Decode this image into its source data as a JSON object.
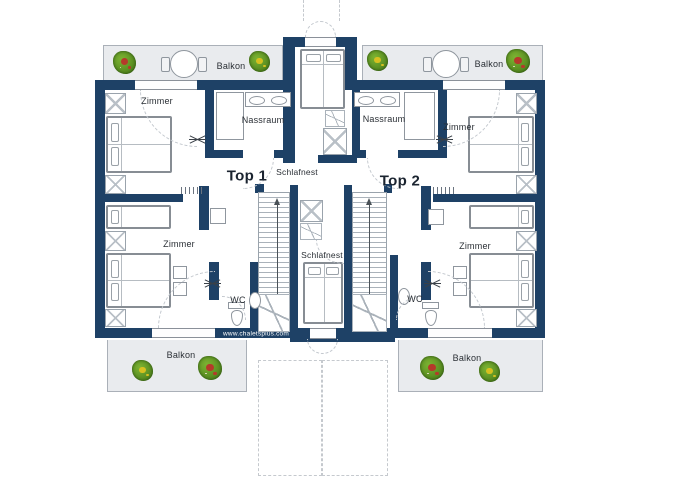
{
  "plan": {
    "apartments": {
      "top1": "Top 1",
      "top2": "Top 2"
    },
    "website": "www.chaletsplus.com",
    "rooms": {
      "balkon_tl": "Balkon",
      "balkon_tr": "Balkon",
      "balkon_bl": "Balkon",
      "balkon_br": "Balkon",
      "zimmer_tl": "Zimmer",
      "zimmer_tr": "Zimmer",
      "zimmer_bl": "Zimmer",
      "zimmer_br": "Zimmer",
      "nassraum_left": "Nassraum",
      "nassraum_right": "Nassraum",
      "schlafnest_top": "Schlafnest",
      "schlafnest_center": "Schlafnest",
      "wc_left": "WC",
      "wc_right": "WC"
    },
    "colors": {
      "wall": "#1e4166",
      "outdoor_floor": "#e9ebee",
      "room_floor": "#ffffff",
      "plant_green": "#55891f",
      "flower_red": "#b53a2a",
      "flower_yellow": "#d6c020",
      "text": "#2a2f35",
      "url_text": "#ffffff"
    }
  }
}
